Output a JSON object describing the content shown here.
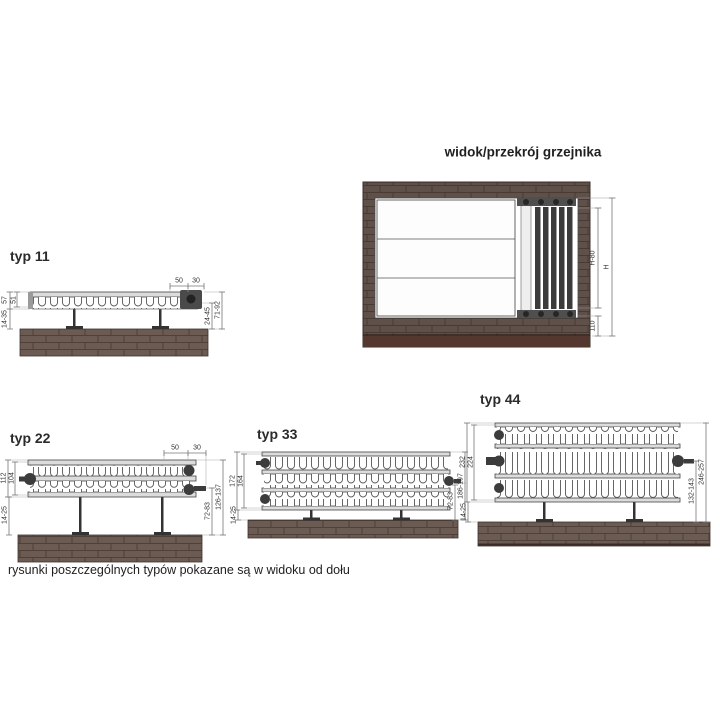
{
  "caption": "rysunki poszczególnych typów pokazane są w widoku od dołu",
  "main_view": {
    "title": "widok/przekrój grzejnika",
    "dims": {
      "height_inner": "H-80",
      "height_total": "H",
      "floor_clearance": "110"
    }
  },
  "types": [
    {
      "label": "typ 11",
      "dims": {
        "top_a": "50",
        "top_b": "30",
        "depth_total": "57",
        "depth_panel": "51",
        "wall_gap": "14-35",
        "wall_mid": "24-45",
        "wall_total": "71-92"
      }
    },
    {
      "label": "typ 22",
      "dims": {
        "top_a": "50",
        "top_b": "30",
        "depth_total": "112",
        "depth_panel": "104",
        "wall_gap": "14-25",
        "wall_mid": "72-83",
        "wall_total": "126-137"
      }
    },
    {
      "label": "typ 33",
      "dims": {
        "depth_total": "172",
        "depth_panel": "164",
        "wall_gap": "14-25",
        "wall_mid": "72-83",
        "wall_total": "186-197"
      }
    },
    {
      "label": "typ 44",
      "dims": {
        "depth_total": "232",
        "depth_panel": "224",
        "wall_gap": "14-25",
        "wall_mid": "132-143",
        "wall_total": "246-257"
      }
    }
  ]
}
